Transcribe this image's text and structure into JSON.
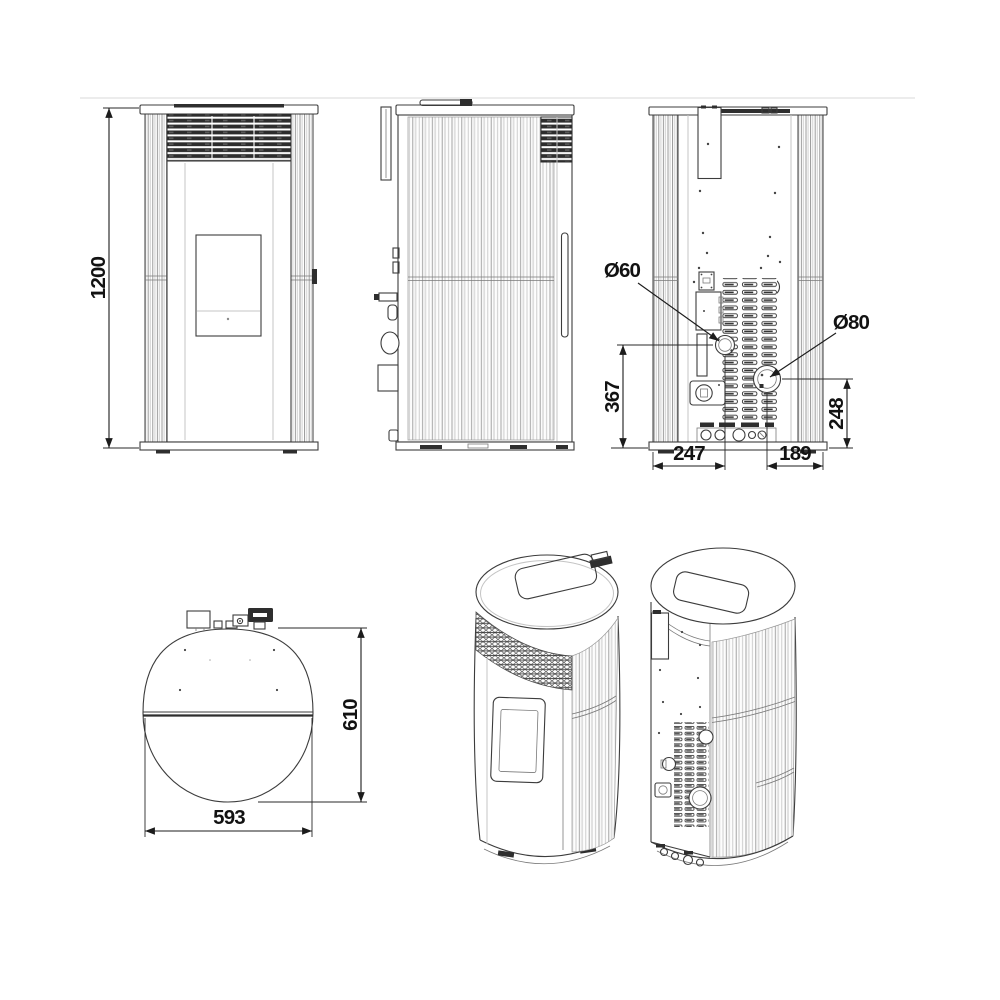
{
  "dimensions": {
    "height": "1200",
    "intake_diameter": "Ø60",
    "flue_diameter": "Ø80",
    "intake_height": "367",
    "flue_height": "248",
    "intake_offset_x": "247",
    "flue_offset_x": "189",
    "depth": "610",
    "width": "593"
  },
  "colors": {
    "background": "#ffffff",
    "line": "#3c3c3c",
    "dimension": "#1c1c1c",
    "grille_dark": "#2e2e2e",
    "divider": "#ececec"
  }
}
